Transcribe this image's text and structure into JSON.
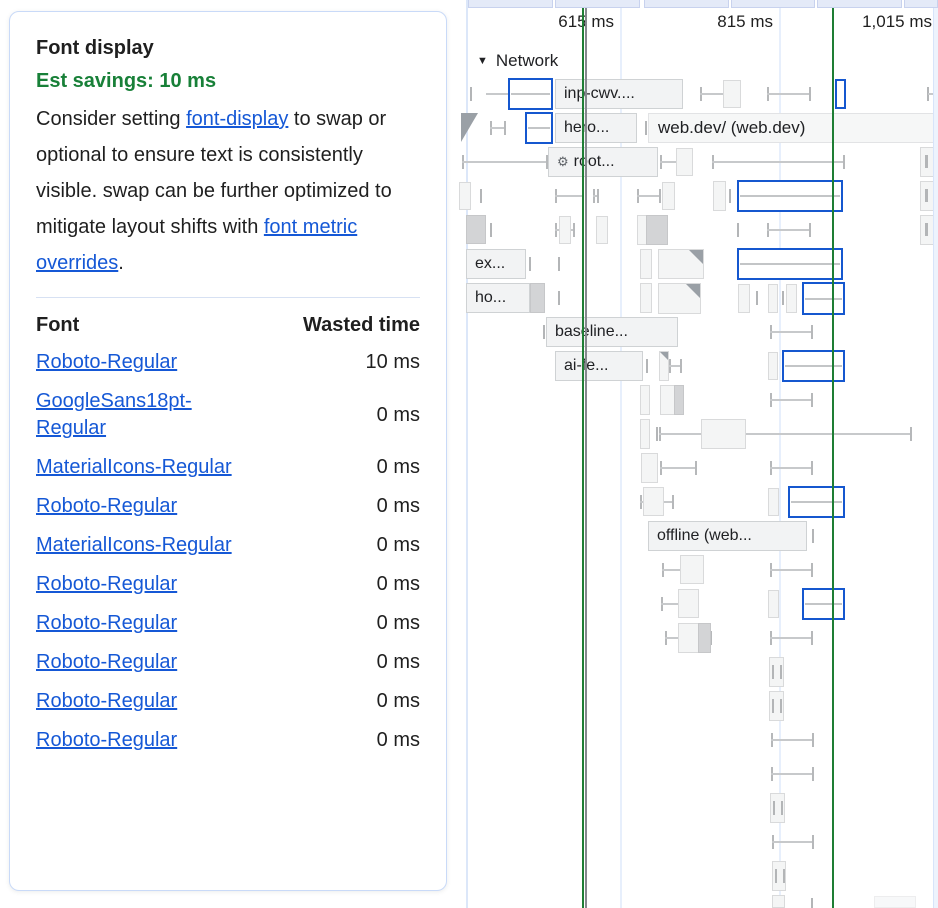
{
  "colors": {
    "savings_green": "#188038",
    "link_blue": "#1558d6",
    "request_blue_outline": "#1557cf",
    "marker_green": "#1e7e34",
    "marker_gray": "#85898e",
    "card_border": "#c9daf8"
  },
  "icons": {
    "gear-icon": "⚙",
    "collapse-icon": "▼"
  },
  "card": {
    "title": "Font display",
    "savings_label": "Est savings: 10 ms",
    "description": [
      {
        "text": "Consider setting "
      },
      {
        "text": "font-display",
        "link": true
      },
      {
        "text": " to swap or optional to ensure text is consistently visible. swap can be further optimized to mitigate layout shifts with "
      },
      {
        "text": "font metric overrides",
        "link": true
      },
      {
        "text": "."
      }
    ],
    "table": {
      "headers": {
        "font": "Font",
        "time": "Wasted time"
      },
      "rows": [
        {
          "font": "Roboto-Regular",
          "time": "10 ms"
        },
        {
          "font": "GoogleSans18pt-Regular",
          "time": "0 ms"
        },
        {
          "font": "MaterialIcons-Regular",
          "time": "0 ms"
        },
        {
          "font": "Roboto-Regular",
          "time": "0 ms"
        },
        {
          "font": "MaterialIcons-Regular",
          "time": "0 ms"
        },
        {
          "font": "Roboto-Regular",
          "time": "0 ms"
        },
        {
          "font": "Roboto-Regular",
          "time": "0 ms"
        },
        {
          "font": "Roboto-Regular",
          "time": "0 ms"
        },
        {
          "font": "Roboto-Regular",
          "time": "0 ms"
        },
        {
          "font": "Roboto-Regular",
          "time": "0 ms"
        }
      ]
    }
  },
  "timeline": {
    "section_label": "Network",
    "ruler": [
      {
        "label": "615 ms",
        "left": 514,
        "width": 100
      },
      {
        "label": "815 ms",
        "left": 673,
        "width": 100
      },
      {
        "label": "1,015 ms",
        "left": 826,
        "width": 106
      }
    ],
    "gridlines": [
      620,
      779
    ],
    "markers": [
      {
        "x": 582,
        "color": "#1e7e34",
        "name": "marker-line-green"
      },
      {
        "x": 585,
        "color": "#85898e",
        "name": "marker-line-gray"
      },
      {
        "x": 832,
        "color": "#1e7e34",
        "name": "marker-line-green"
      }
    ],
    "top_segments": [
      [
        468,
        85
      ],
      [
        555,
        85
      ],
      [
        644,
        85
      ],
      [
        731,
        84
      ],
      [
        817,
        85
      ],
      [
        904,
        34
      ]
    ],
    "items": [
      {
        "t": "tick",
        "x": 470,
        "y": 87,
        "w": 2,
        "h": 14
      },
      {
        "t": "hline",
        "x": 486,
        "y": 93,
        "w": 24,
        "h": 2
      },
      {
        "t": "blue",
        "x": 508,
        "y": 78,
        "w": 45,
        "h": 32,
        "line": 1
      },
      {
        "t": "label",
        "x": 555,
        "y": 79,
        "w": 128,
        "h": 30,
        "text": "inp-cwv...."
      },
      {
        "t": "whisker",
        "x": 700,
        "y": 87,
        "w": 41,
        "h": 14
      },
      {
        "t": "box",
        "x": 723,
        "y": 80,
        "w": 18,
        "h": 28
      },
      {
        "t": "whisker",
        "x": 767,
        "y": 87,
        "w": 44,
        "h": 14
      },
      {
        "t": "blue",
        "x": 835,
        "y": 79,
        "w": 11,
        "h": 30
      },
      {
        "t": "tick",
        "x": 927,
        "y": 87,
        "w": 2,
        "h": 14
      },
      {
        "t": "hline",
        "x": 928,
        "y": 93,
        "w": 10,
        "h": 2
      },
      {
        "t": "tri",
        "x": 461,
        "y": 113,
        "w": 17,
        "h": 29
      },
      {
        "t": "whisker",
        "x": 490,
        "y": 121,
        "w": 16,
        "h": 14
      },
      {
        "t": "blue",
        "x": 525,
        "y": 112,
        "w": 28,
        "h": 32,
        "line": 1
      },
      {
        "t": "label",
        "x": 555,
        "y": 113,
        "w": 82,
        "h": 30,
        "text": "hero..."
      },
      {
        "t": "tick",
        "x": 645,
        "y": 121,
        "w": 2,
        "h": 14
      },
      {
        "t": "bar",
        "x": 648,
        "y": 113,
        "w": 290,
        "h": 30,
        "text": "web.dev/ (web.dev)"
      },
      {
        "t": "whisker",
        "x": 462,
        "y": 155,
        "w": 86,
        "h": 14
      },
      {
        "t": "label",
        "x": 548,
        "y": 147,
        "w": 110,
        "h": 30,
        "text": "root...",
        "icon": "gear-icon"
      },
      {
        "t": "whisker",
        "x": 660,
        "y": 155,
        "w": 33,
        "h": 14
      },
      {
        "t": "box",
        "x": 676,
        "y": 148,
        "w": 17,
        "h": 28
      },
      {
        "t": "whisker",
        "x": 712,
        "y": 155,
        "w": 133,
        "h": 14
      },
      {
        "t": "box",
        "x": 920,
        "y": 147,
        "w": 18,
        "h": 30
      },
      {
        "t": "tick",
        "x": 925,
        "y": 155,
        "w": 3,
        "h": 13
      },
      {
        "t": "box",
        "x": 459,
        "y": 182,
        "w": 12,
        "h": 28
      },
      {
        "t": "tick",
        "x": 480,
        "y": 189,
        "w": 2,
        "h": 14
      },
      {
        "t": "whisker",
        "x": 555,
        "y": 189,
        "w": 29,
        "h": 14
      },
      {
        "t": "whisker",
        "x": 593,
        "y": 189,
        "w": 6,
        "h": 14
      },
      {
        "t": "whisker",
        "x": 637,
        "y": 189,
        "w": 24,
        "h": 14
      },
      {
        "t": "box",
        "x": 662,
        "y": 182,
        "w": 13,
        "h": 28
      },
      {
        "t": "box",
        "x": 713,
        "y": 181,
        "w": 13,
        "h": 30
      },
      {
        "t": "tick",
        "x": 729,
        "y": 189,
        "w": 2,
        "h": 14
      },
      {
        "t": "blue",
        "x": 737,
        "y": 180,
        "w": 106,
        "h": 32,
        "line": 1
      },
      {
        "t": "box",
        "x": 920,
        "y": 181,
        "w": 18,
        "h": 30
      },
      {
        "t": "tick",
        "x": 925,
        "y": 189,
        "w": 3,
        "h": 13
      },
      {
        "t": "dark",
        "x": 466,
        "y": 215,
        "w": 20,
        "h": 29
      },
      {
        "t": "tick",
        "x": 490,
        "y": 223,
        "w": 2,
        "h": 14
      },
      {
        "t": "whisker",
        "x": 555,
        "y": 223,
        "w": 20,
        "h": 14
      },
      {
        "t": "box",
        "x": 559,
        "y": 216,
        "w": 12,
        "h": 28
      },
      {
        "t": "box",
        "x": 596,
        "y": 216,
        "w": 12,
        "h": 28
      },
      {
        "t": "box",
        "x": 637,
        "y": 215,
        "w": 31,
        "h": 30
      },
      {
        "t": "dark",
        "x": 646,
        "y": 215,
        "w": 22,
        "h": 30
      },
      {
        "t": "tick",
        "x": 737,
        "y": 223,
        "w": 2,
        "h": 14
      },
      {
        "t": "whisker",
        "x": 767,
        "y": 223,
        "w": 44,
        "h": 14
      },
      {
        "t": "box",
        "x": 920,
        "y": 215,
        "w": 18,
        "h": 30
      },
      {
        "t": "tick",
        "x": 925,
        "y": 223,
        "w": 3,
        "h": 13
      },
      {
        "t": "label",
        "x": 466,
        "y": 249,
        "w": 60,
        "h": 30,
        "text": "ex..."
      },
      {
        "t": "tick",
        "x": 529,
        "y": 257,
        "w": 2,
        "h": 14
      },
      {
        "t": "tick",
        "x": 558,
        "y": 257,
        "w": 2,
        "h": 14
      },
      {
        "t": "box",
        "x": 640,
        "y": 249,
        "w": 12,
        "h": 30
      },
      {
        "t": "fold",
        "x": 658,
        "y": 249,
        "w": 46,
        "h": 30
      },
      {
        "t": "blue",
        "x": 737,
        "y": 248,
        "w": 106,
        "h": 32,
        "line": 1
      },
      {
        "t": "label",
        "x": 466,
        "y": 283,
        "w": 64,
        "h": 30,
        "text": "ho..."
      },
      {
        "t": "dark",
        "x": 530,
        "y": 283,
        "w": 15,
        "h": 30
      },
      {
        "t": "tick",
        "x": 558,
        "y": 291,
        "w": 2,
        "h": 14
      },
      {
        "t": "box",
        "x": 640,
        "y": 283,
        "w": 12,
        "h": 30
      },
      {
        "t": "fold",
        "x": 658,
        "y": 283,
        "w": 43,
        "h": 31
      },
      {
        "t": "box",
        "x": 738,
        "y": 284,
        "w": 12,
        "h": 29
      },
      {
        "t": "tick",
        "x": 756,
        "y": 291,
        "w": 2,
        "h": 14
      },
      {
        "t": "box",
        "x": 768,
        "y": 284,
        "w": 10,
        "h": 29
      },
      {
        "t": "tick",
        "x": 782,
        "y": 291,
        "w": 2,
        "h": 14
      },
      {
        "t": "box",
        "x": 786,
        "y": 284,
        "w": 11,
        "h": 29
      },
      {
        "t": "blue",
        "x": 802,
        "y": 282,
        "w": 43,
        "h": 33,
        "line": 1
      },
      {
        "t": "tick",
        "x": 543,
        "y": 325,
        "w": 2,
        "h": 14
      },
      {
        "t": "label",
        "x": 546,
        "y": 317,
        "w": 132,
        "h": 30,
        "text": "baseline..."
      },
      {
        "t": "whisker",
        "x": 770,
        "y": 325,
        "w": 43,
        "h": 14
      },
      {
        "t": "label",
        "x": 555,
        "y": 351,
        "w": 88,
        "h": 30,
        "text": "ai-fe..."
      },
      {
        "t": "tick",
        "x": 646,
        "y": 359,
        "w": 2,
        "h": 14
      },
      {
        "t": "fold",
        "x": 659,
        "y": 351,
        "w": 10,
        "h": 30
      },
      {
        "t": "whisker",
        "x": 669,
        "y": 359,
        "w": 13,
        "h": 14
      },
      {
        "t": "box",
        "x": 768,
        "y": 352,
        "w": 10,
        "h": 28
      },
      {
        "t": "blue",
        "x": 782,
        "y": 350,
        "w": 63,
        "h": 32,
        "line": 1
      },
      {
        "t": "box",
        "x": 640,
        "y": 385,
        "w": 10,
        "h": 30
      },
      {
        "t": "box",
        "x": 660,
        "y": 385,
        "w": 24,
        "h": 30
      },
      {
        "t": "dark",
        "x": 674,
        "y": 385,
        "w": 10,
        "h": 30
      },
      {
        "t": "whisker",
        "x": 770,
        "y": 393,
        "w": 43,
        "h": 14
      },
      {
        "t": "box",
        "x": 640,
        "y": 419,
        "w": 10,
        "h": 30
      },
      {
        "t": "tick",
        "x": 656,
        "y": 427,
        "w": 2,
        "h": 14
      },
      {
        "t": "whisker",
        "x": 659,
        "y": 427,
        "w": 253,
        "h": 14
      },
      {
        "t": "box",
        "x": 701,
        "y": 419,
        "w": 45,
        "h": 30
      },
      {
        "t": "box",
        "x": 641,
        "y": 453,
        "w": 17,
        "h": 30
      },
      {
        "t": "whisker",
        "x": 660,
        "y": 461,
        "w": 37,
        "h": 14
      },
      {
        "t": "whisker",
        "x": 770,
        "y": 461,
        "w": 43,
        "h": 14
      },
      {
        "t": "whisker",
        "x": 640,
        "y": 495,
        "w": 34,
        "h": 14
      },
      {
        "t": "box",
        "x": 643,
        "y": 487,
        "w": 21,
        "h": 29
      },
      {
        "t": "box",
        "x": 768,
        "y": 488,
        "w": 11,
        "h": 28
      },
      {
        "t": "blue",
        "x": 788,
        "y": 486,
        "w": 57,
        "h": 32,
        "line": 1
      },
      {
        "t": "label",
        "x": 648,
        "y": 521,
        "w": 159,
        "h": 30,
        "text": "offline (web..."
      },
      {
        "t": "tick",
        "x": 812,
        "y": 529,
        "w": 2,
        "h": 14
      },
      {
        "t": "whisker",
        "x": 662,
        "y": 563,
        "w": 42,
        "h": 14
      },
      {
        "t": "box",
        "x": 680,
        "y": 555,
        "w": 24,
        "h": 29
      },
      {
        "t": "whisker",
        "x": 770,
        "y": 563,
        "w": 43,
        "h": 14
      },
      {
        "t": "whisker",
        "x": 661,
        "y": 597,
        "w": 38,
        "h": 14
      },
      {
        "t": "box",
        "x": 678,
        "y": 589,
        "w": 21,
        "h": 29
      },
      {
        "t": "box",
        "x": 768,
        "y": 590,
        "w": 11,
        "h": 28
      },
      {
        "t": "blue",
        "x": 802,
        "y": 588,
        "w": 43,
        "h": 32,
        "line": 1
      },
      {
        "t": "whisker",
        "x": 665,
        "y": 631,
        "w": 47,
        "h": 14
      },
      {
        "t": "box",
        "x": 678,
        "y": 623,
        "w": 33,
        "h": 30
      },
      {
        "t": "dark",
        "x": 698,
        "y": 623,
        "w": 13,
        "h": 30
      },
      {
        "t": "whisker",
        "x": 770,
        "y": 631,
        "w": 43,
        "h": 14
      },
      {
        "t": "box",
        "x": 769,
        "y": 657,
        "w": 15,
        "h": 30
      },
      {
        "t": "tick",
        "x": 772,
        "y": 665,
        "w": 2,
        "h": 14
      },
      {
        "t": "tick",
        "x": 780,
        "y": 665,
        "w": 2,
        "h": 14
      },
      {
        "t": "box",
        "x": 769,
        "y": 691,
        "w": 15,
        "h": 30
      },
      {
        "t": "tick",
        "x": 772,
        "y": 699,
        "w": 2,
        "h": 14
      },
      {
        "t": "tick",
        "x": 780,
        "y": 699,
        "w": 2,
        "h": 14
      },
      {
        "t": "whisker",
        "x": 771,
        "y": 733,
        "w": 43,
        "h": 14
      },
      {
        "t": "whisker",
        "x": 771,
        "y": 767,
        "w": 43,
        "h": 14
      },
      {
        "t": "box",
        "x": 770,
        "y": 793,
        "w": 15,
        "h": 30
      },
      {
        "t": "tick",
        "x": 773,
        "y": 801,
        "w": 2,
        "h": 14
      },
      {
        "t": "tick",
        "x": 781,
        "y": 801,
        "w": 2,
        "h": 14
      },
      {
        "t": "whisker",
        "x": 772,
        "y": 835,
        "w": 42,
        "h": 14
      },
      {
        "t": "box",
        "x": 772,
        "y": 861,
        "w": 14,
        "h": 30
      },
      {
        "t": "tick",
        "x": 775,
        "y": 869,
        "w": 2,
        "h": 14
      },
      {
        "t": "tick",
        "x": 783,
        "y": 869,
        "w": 2,
        "h": 14
      },
      {
        "t": "box",
        "x": 772,
        "y": 895,
        "w": 13,
        "h": 13
      },
      {
        "t": "tick",
        "x": 811,
        "y": 898,
        "w": 2,
        "h": 10
      },
      {
        "t": "faint",
        "x": 874,
        "y": 896,
        "w": 42,
        "h": 12
      }
    ]
  }
}
